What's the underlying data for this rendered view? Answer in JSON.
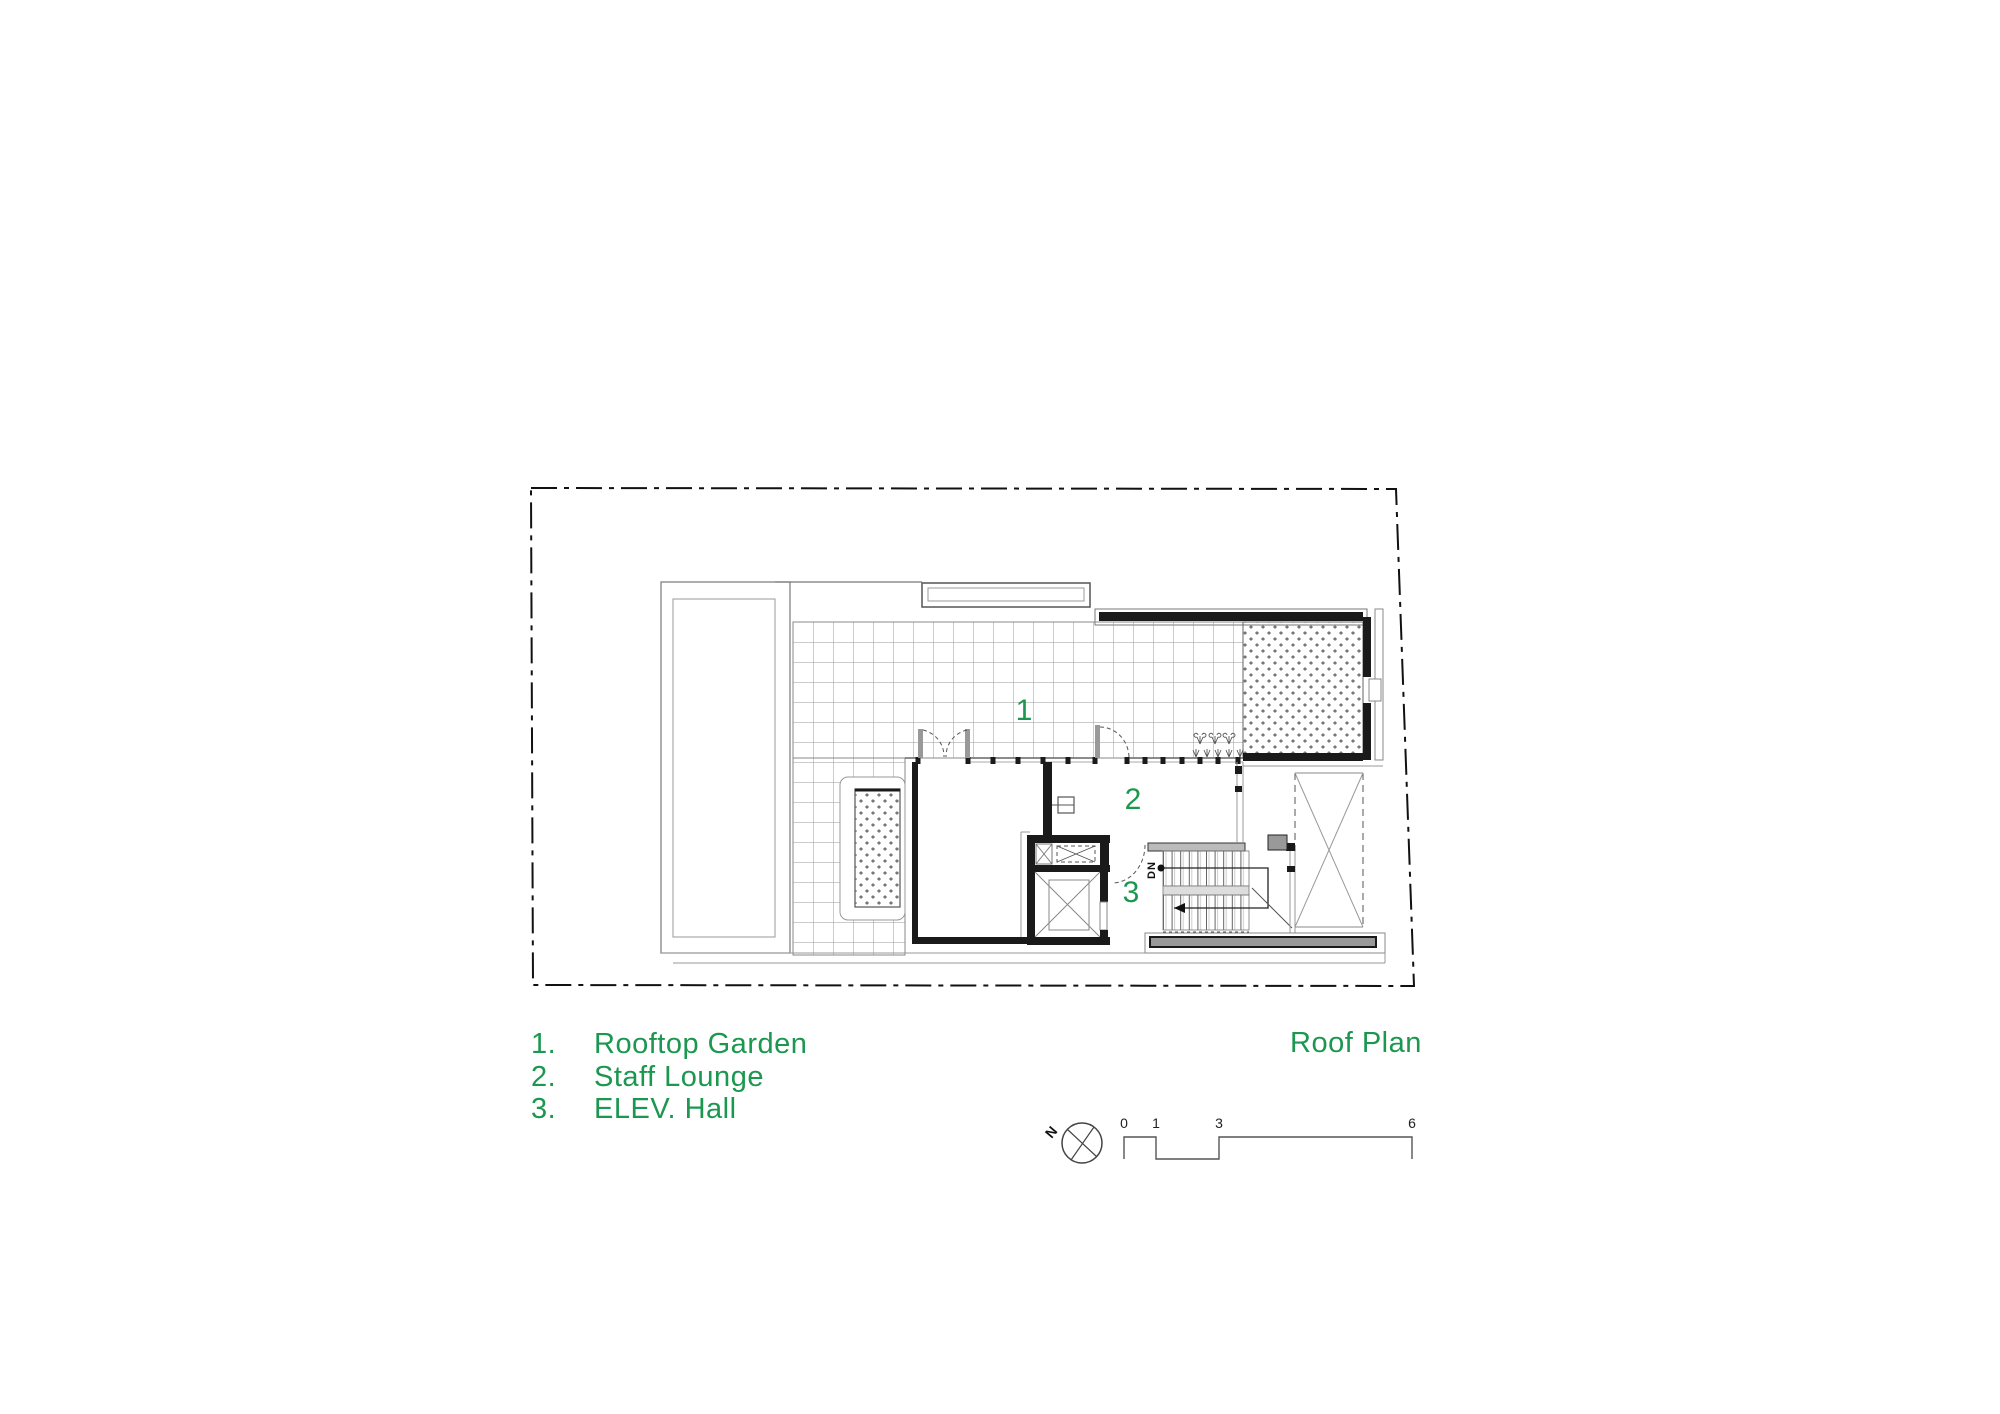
{
  "title": "Roof Plan",
  "legend": {
    "items": [
      {
        "num": "1.",
        "label": "Rooftop Garden"
      },
      {
        "num": "2.",
        "label": "Staff Lounge"
      },
      {
        "num": "3.",
        "label": "ELEV. Hall"
      }
    ]
  },
  "plan": {
    "labels": {
      "rooftop_garden": "1",
      "staff_lounge": "2",
      "elev_hall": "3",
      "stair_direction": "DN"
    }
  },
  "north_arrow": {
    "label": "N"
  },
  "scale_bar": {
    "ticks": [
      "0",
      "1",
      "3",
      "6"
    ]
  },
  "colors": {
    "annotation_green": "#1b9750",
    "wall_black": "#1a1a1a"
  }
}
